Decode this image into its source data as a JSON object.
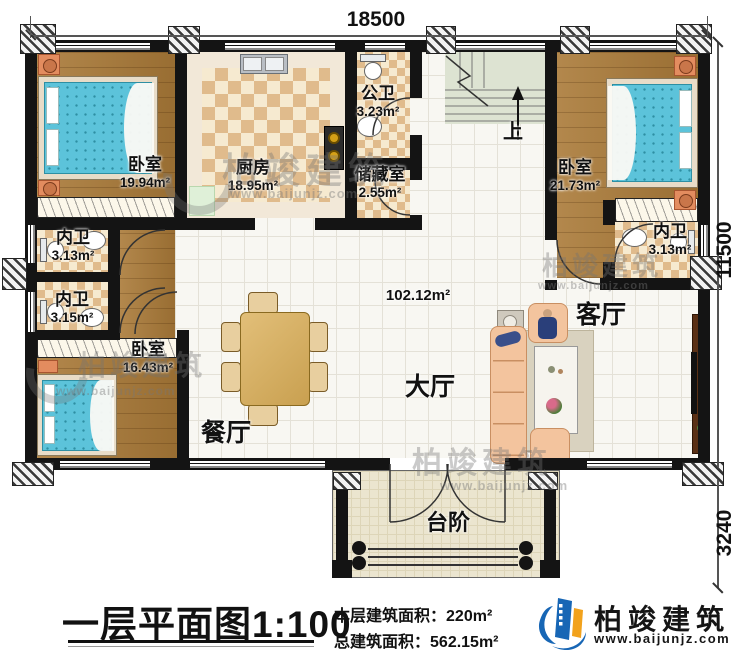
{
  "dimensions": {
    "top": "18500",
    "side_main": "11500",
    "side_porch": "3240"
  },
  "rooms": {
    "bedroom_tl": {
      "name": "卧室",
      "area": "19.94m²"
    },
    "kitchen": {
      "name": "厨房",
      "area": "18.95m²"
    },
    "public_bath": {
      "name": "公卫",
      "area": "3.23m²"
    },
    "storage": {
      "name": "储藏室",
      "area": "2.55m²"
    },
    "bedroom_tr": {
      "name": "卧室",
      "area": "21.73m²"
    },
    "bath_tr": {
      "name": "内卫",
      "area": "3.13m²"
    },
    "bath_left_upper": {
      "name": "内卫",
      "area": "3.13m²"
    },
    "bath_left_lower": {
      "name": "内卫",
      "area": "3.15m²"
    },
    "bedroom_bl": {
      "name": "卧室",
      "area": "16.43m²"
    },
    "hall": {
      "name": "大厅",
      "area": "102.12m²"
    },
    "dining": {
      "name": "餐厅"
    },
    "living": {
      "name": "客厅"
    },
    "stairs": {
      "up_label": "上"
    },
    "porch": {
      "name": "台阶"
    }
  },
  "title_block": {
    "title": "一层平面图1:100",
    "floor_area_label": "本层建筑面积：",
    "floor_area_value": "220m²",
    "total_area_label": "总建筑面积：",
    "total_area_value": "562.15m²"
  },
  "logo": {
    "company": "柏竣建筑",
    "website": "www.baijunjz.com"
  },
  "watermark": {
    "brand": "柏竣建筑",
    "url": "www.baijunjz.com"
  },
  "colors": {
    "wall": "#141414",
    "wood": "#aa7a38",
    "bed": "#5cc3da",
    "accent_blue": "#1766b5",
    "accent_orange": "#f2a21c"
  }
}
